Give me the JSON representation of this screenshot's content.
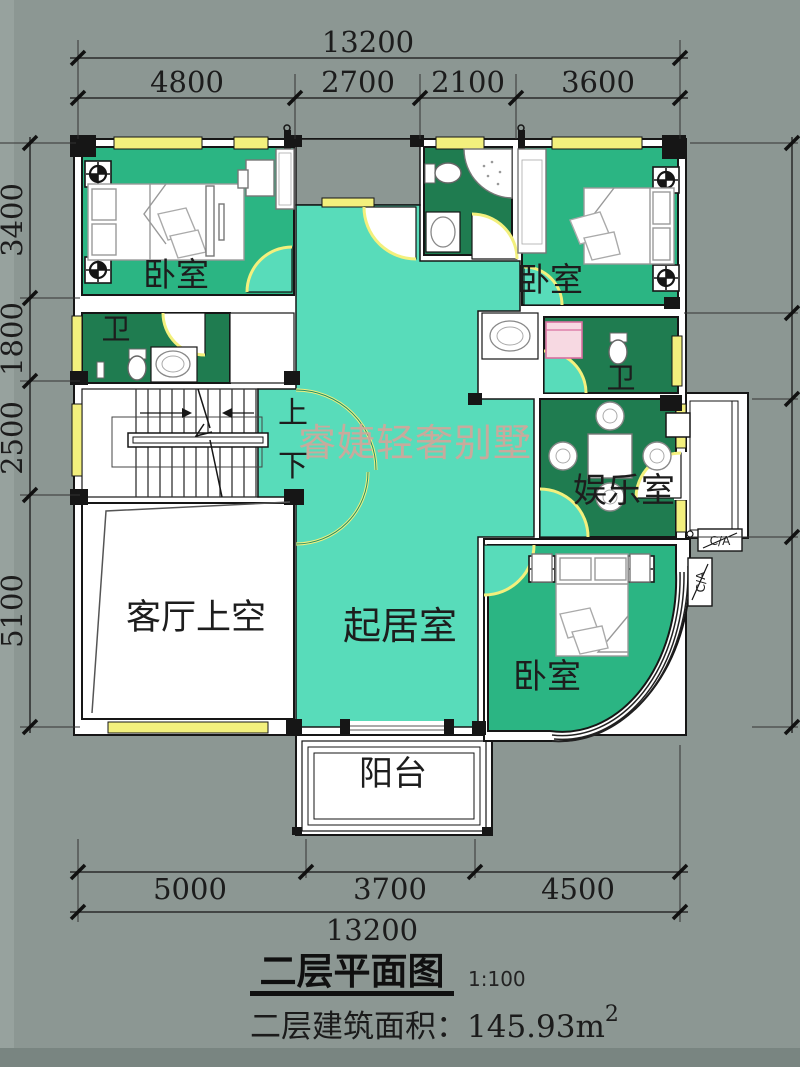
{
  "title": {
    "text": "二层平面图",
    "scale": "1:100",
    "area_label": "二层建筑面积：",
    "area_value": "145.93m",
    "area_sup": "2"
  },
  "watermark": "睿婕轻奢别墅",
  "dimensions": {
    "top_total": "13200",
    "top_segments": [
      "4800",
      "2700",
      "2100",
      "3600"
    ],
    "left_segments": [
      "3400",
      "1800",
      "2500",
      "5100"
    ],
    "bottom_segments": [
      "5000",
      "3700",
      "4500"
    ],
    "bottom_total": "13200"
  },
  "rooms": {
    "bedroom_tl": "卧室",
    "bath_tl": "卫",
    "bedroom_tr": "卧室",
    "bath_tr": "卫",
    "entertainment": "娱乐室",
    "living_void": "客厅上空",
    "sitting": "起居室",
    "bedroom_br": "卧室",
    "balcony": "阳台",
    "stair_up": "上",
    "stair_down": "下",
    "ac_unit": "C/A"
  },
  "colors": {
    "background": "#8C9793",
    "bedroom_green": "#2BB583",
    "bath_green": "#1F7C50",
    "hall_teal": "#58DCBA",
    "window_yellow": "#F3F07D",
    "watermark_pink": "#D2A69A",
    "wall_black": "#161616",
    "floor_white": "#FFFFFF"
  }
}
